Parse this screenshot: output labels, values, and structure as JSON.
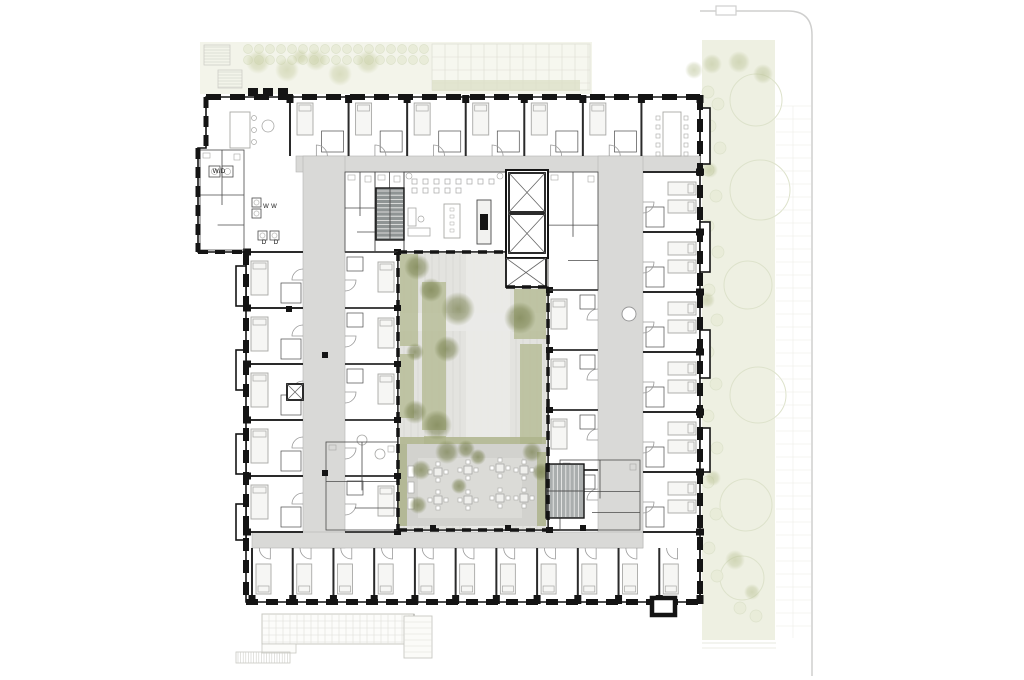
{
  "meta": {
    "kind": "architectural-floor-plan",
    "width": 1024,
    "height": 680
  },
  "labels": [
    {
      "id": "washer-dryer",
      "text": "W/D",
      "x": 219,
      "y": 173,
      "size": 6.5
    },
    {
      "id": "washer-1",
      "text": "W",
      "x": 266,
      "y": 208,
      "size": 6
    },
    {
      "id": "washer-2",
      "text": "W",
      "x": 274,
      "y": 208,
      "size": 6
    },
    {
      "id": "dryer-1",
      "text": "D",
      "x": 264,
      "y": 244,
      "size": 6.5
    },
    {
      "id": "dryer-2",
      "text": "D",
      "x": 276,
      "y": 244,
      "size": 6.5
    }
  ],
  "colors": {
    "wall": "#141414",
    "thin": "#4a4a4a",
    "partition": "#2a2a2a",
    "corridor": "#d9d9d7",
    "corridorEdge": "#b3b3b1",
    "furn": "#a8a8a6",
    "bedFill": "#f6f6f4",
    "courtBase": "#e3e3df",
    "courtJoint": "#cfcfc9",
    "courtWalk": "#eaeae7",
    "plant": "#b7bd99",
    "hedge": "#aeb48c",
    "patio": "#d2d2ce",
    "patioIn": "#dbdbd7",
    "tree": "#78804e",
    "siteTree": "#b9c194",
    "landStrip": "#f3f4ea",
    "landBand": "#eef0e2",
    "landCircle": "#dde2cb",
    "landFill": "#e9ecd9",
    "bush": "#c7cda2",
    "gridLine": "#dcdcd2",
    "terraceLine": "#c8c8c2",
    "propertyLine": "#cfcfce",
    "stairA": "#8f9494",
    "stairB": "#aaaeae",
    "tread": "#f0f0ef"
  },
  "site": {
    "top_strip": {
      "x": 200,
      "y": 42,
      "w": 392,
      "h": 52
    },
    "paver_grid": {
      "x": 432,
      "y": 44,
      "w": 158,
      "h": 46,
      "step": 13
    },
    "hedge_row": {
      "x": 432,
      "y": 80,
      "w": 148,
      "h": 11
    },
    "stair_treads": [
      [
        204,
        45,
        26,
        20
      ],
      [
        218,
        70,
        24,
        18
      ]
    ],
    "shrub_rows": {
      "x0": 248,
      "x1": 424,
      "rows": [
        49,
        60
      ],
      "r": 4.5,
      "step": 11
    },
    "bushes": [
      [
        258,
        62,
        12
      ],
      [
        287,
        70,
        12
      ],
      [
        316,
        60,
        11
      ],
      [
        340,
        74,
        12
      ],
      [
        368,
        62,
        12
      ],
      [
        300,
        57,
        8
      ]
    ],
    "right_band": {
      "x": 702,
      "y": 40,
      "w": 73,
      "h": 600
    },
    "band_circles": [
      [
        756,
        100,
        26
      ],
      [
        760,
        190,
        30
      ],
      [
        748,
        285,
        24
      ],
      [
        758,
        395,
        28
      ],
      [
        746,
        505,
        26
      ],
      [
        742,
        578,
        22
      ]
    ],
    "band_shrubs": [
      [
        708,
        92
      ],
      [
        718,
        104
      ],
      [
        710,
        126
      ],
      [
        720,
        148
      ],
      [
        708,
        170
      ],
      [
        716,
        196
      ],
      [
        708,
        226
      ],
      [
        718,
        252
      ],
      [
        709,
        290
      ],
      [
        717,
        320
      ],
      [
        708,
        352
      ],
      [
        716,
        384
      ],
      [
        708,
        416
      ],
      [
        717,
        448
      ],
      [
        708,
        482
      ],
      [
        716,
        514
      ],
      [
        709,
        548
      ],
      [
        717,
        576
      ],
      [
        740,
        608
      ],
      [
        756,
        616
      ]
    ],
    "band_trees": [
      [
        712,
        64,
        10
      ],
      [
        739,
        62,
        11
      ],
      [
        763,
        74,
        10
      ],
      [
        694,
        70,
        9
      ],
      [
        710,
        170,
        8
      ],
      [
        707,
        300,
        8
      ],
      [
        713,
        478,
        8
      ],
      [
        735,
        560,
        10
      ],
      [
        752,
        592,
        8
      ]
    ],
    "paver_lines": {
      "x0": 776,
      "x1": 811,
      "y0": 106,
      "y1": 638,
      "step": 13,
      "vx": 793
    },
    "property": {
      "h_x0": 700,
      "h_x1": 788,
      "h_y": 11,
      "r": 24,
      "v_x": 812,
      "v_y1": 676,
      "notch": [
        716,
        6,
        20,
        9
      ]
    },
    "terrace": {
      "x": 262,
      "y": 614,
      "w": 152,
      "h": 30,
      "step": 7,
      "ext": [
        262,
        644,
        34,
        9
      ],
      "ramp": [
        236,
        652,
        54,
        11
      ],
      "patch": [
        404,
        616,
        28,
        42
      ]
    }
  },
  "building": {
    "outer": [
      [
        206,
        97
      ],
      [
        700,
        97
      ],
      [
        700,
        602
      ],
      [
        246,
        602
      ],
      [
        246,
        252
      ],
      [
        198,
        252
      ],
      [
        198,
        148
      ],
      [
        206,
        148
      ]
    ],
    "court": [
      [
        398,
        252
      ],
      [
        506,
        252
      ],
      [
        506,
        287
      ],
      [
        548,
        287
      ],
      [
        548,
        530
      ],
      [
        398,
        530
      ]
    ],
    "bays_right": [
      [
        700,
        108,
        10,
        56
      ],
      [
        700,
        222,
        10,
        50
      ],
      [
        700,
        330,
        10,
        48
      ],
      [
        700,
        428,
        10,
        44
      ]
    ],
    "bays_left": [
      [
        236,
        266,
        10,
        40
      ],
      [
        236,
        350,
        10,
        40
      ],
      [
        236,
        434,
        10,
        40
      ],
      [
        236,
        504,
        10,
        36
      ]
    ],
    "parapet": [
      248,
      92,
      44
    ],
    "corridors": [
      [
        296,
        156,
        404,
        16
      ],
      [
        303,
        156,
        42,
        392
      ],
      [
        598,
        156,
        45,
        392
      ],
      [
        252,
        532,
        391,
        16
      ]
    ],
    "columns": [
      [
        286,
        306
      ],
      [
        322,
        352
      ],
      [
        322,
        470
      ],
      [
        430,
        525
      ],
      [
        505,
        525
      ],
      [
        580,
        525
      ]
    ],
    "corridor_circle": [
      629,
      314,
      7
    ],
    "vent_square": [
      652,
      598,
      23,
      17
    ]
  },
  "wings": {
    "top": {
      "x0": 290,
      "x1": 700,
      "y0": 97,
      "y1": 156,
      "count": 7
    },
    "bottom": {
      "x0": 252,
      "x1": 700,
      "y0": 548,
      "y1": 600,
      "count": 11
    },
    "left_outer": {
      "x0": 246,
      "x1": 303,
      "y0": 252,
      "y1": 532,
      "count": 5
    },
    "left_inner": {
      "x0": 345,
      "x1": 398,
      "y0": 252,
      "y1": 532,
      "count": 5
    },
    "right_outer": {
      "x0": 643,
      "x1": 700,
      "y0": 172,
      "y1": 532,
      "count": 6
    },
    "right_inner": {
      "x0": 548,
      "x1": 598,
      "y0": 290,
      "y1": 530,
      "count": 4
    }
  },
  "core": {
    "shaft_main": [
      506,
      170,
      42,
      88
    ],
    "shaft_small": [
      506,
      258,
      40,
      29
    ],
    "stair_a": [
      376,
      188,
      28,
      52
    ],
    "stair_b": [
      546,
      464,
      38,
      54
    ]
  },
  "common": {
    "lounge": {
      "x": 404,
      "y": 172,
      "w": 102,
      "h": 80
    },
    "dining_table": [
      663,
      112,
      18,
      44
    ],
    "kitchen_island": [
      230,
      112,
      20,
      36
    ],
    "stools": [
      [
        254,
        118
      ],
      [
        254,
        130
      ],
      [
        254,
        142
      ]
    ],
    "round_table": [
      268,
      126,
      6
    ],
    "laundry_machines": [
      [
        209,
        166,
        11,
        11
      ],
      [
        222,
        166,
        11,
        11
      ],
      [
        252,
        198,
        9,
        9
      ],
      [
        252,
        209,
        9,
        9
      ],
      [
        258,
        231,
        9,
        9
      ],
      [
        270,
        231,
        9,
        9
      ]
    ],
    "clusters": [
      [
        326,
        442,
        72,
        88
      ],
      [
        560,
        460,
        80,
        70
      ],
      [
        548,
        172,
        50,
        118
      ],
      [
        200,
        150,
        44,
        100
      ],
      [
        345,
        172,
        30,
        80
      ],
      [
        375,
        172,
        29,
        80
      ]
    ]
  },
  "courtyard": {
    "x": 398,
    "y": 252,
    "w": 150,
    "h": 278,
    "walk": [
      466,
      252,
      44,
      278
    ],
    "cross": [
      398,
      313,
      150,
      18
    ],
    "planters": [
      [
        400,
        254,
        18,
        92
      ],
      [
        422,
        282,
        24,
        148
      ],
      [
        424,
        436,
        22,
        72
      ],
      [
        514,
        289,
        32,
        50
      ],
      [
        520,
        344,
        22,
        112
      ],
      [
        400,
        354,
        14,
        64
      ]
    ],
    "patio": {
      "rect": [
        400,
        444,
        146,
        82
      ],
      "hedge_top": [
        400,
        437,
        146,
        10
      ],
      "hedge_left": [
        398,
        444,
        9,
        82
      ],
      "hedge_right": [
        537,
        452,
        9,
        74
      ],
      "inner": [
        418,
        458,
        104,
        60
      ]
    },
    "tables": [
      [
        438,
        472
      ],
      [
        438,
        500
      ],
      [
        468,
        470
      ],
      [
        468,
        500
      ],
      [
        500,
        468
      ],
      [
        500,
        498
      ],
      [
        524,
        470
      ],
      [
        524,
        498
      ]
    ],
    "loungers": [
      [
        408,
        466
      ],
      [
        408,
        482
      ],
      [
        408,
        498
      ]
    ],
    "trees": [
      [
        417,
        267,
        13
      ],
      [
        431,
        290,
        12
      ],
      [
        458,
        309,
        17
      ],
      [
        520,
        318,
        16
      ],
      [
        415,
        352,
        9
      ],
      [
        447,
        349,
        13
      ],
      [
        415,
        412,
        12
      ],
      [
        437,
        425,
        15
      ],
      [
        421,
        470,
        10
      ],
      [
        447,
        452,
        12
      ],
      [
        466,
        449,
        9
      ],
      [
        478,
        457,
        8
      ],
      [
        532,
        452,
        10
      ],
      [
        541,
        472,
        9
      ],
      [
        459,
        486,
        8
      ],
      [
        418,
        505,
        9
      ]
    ]
  }
}
